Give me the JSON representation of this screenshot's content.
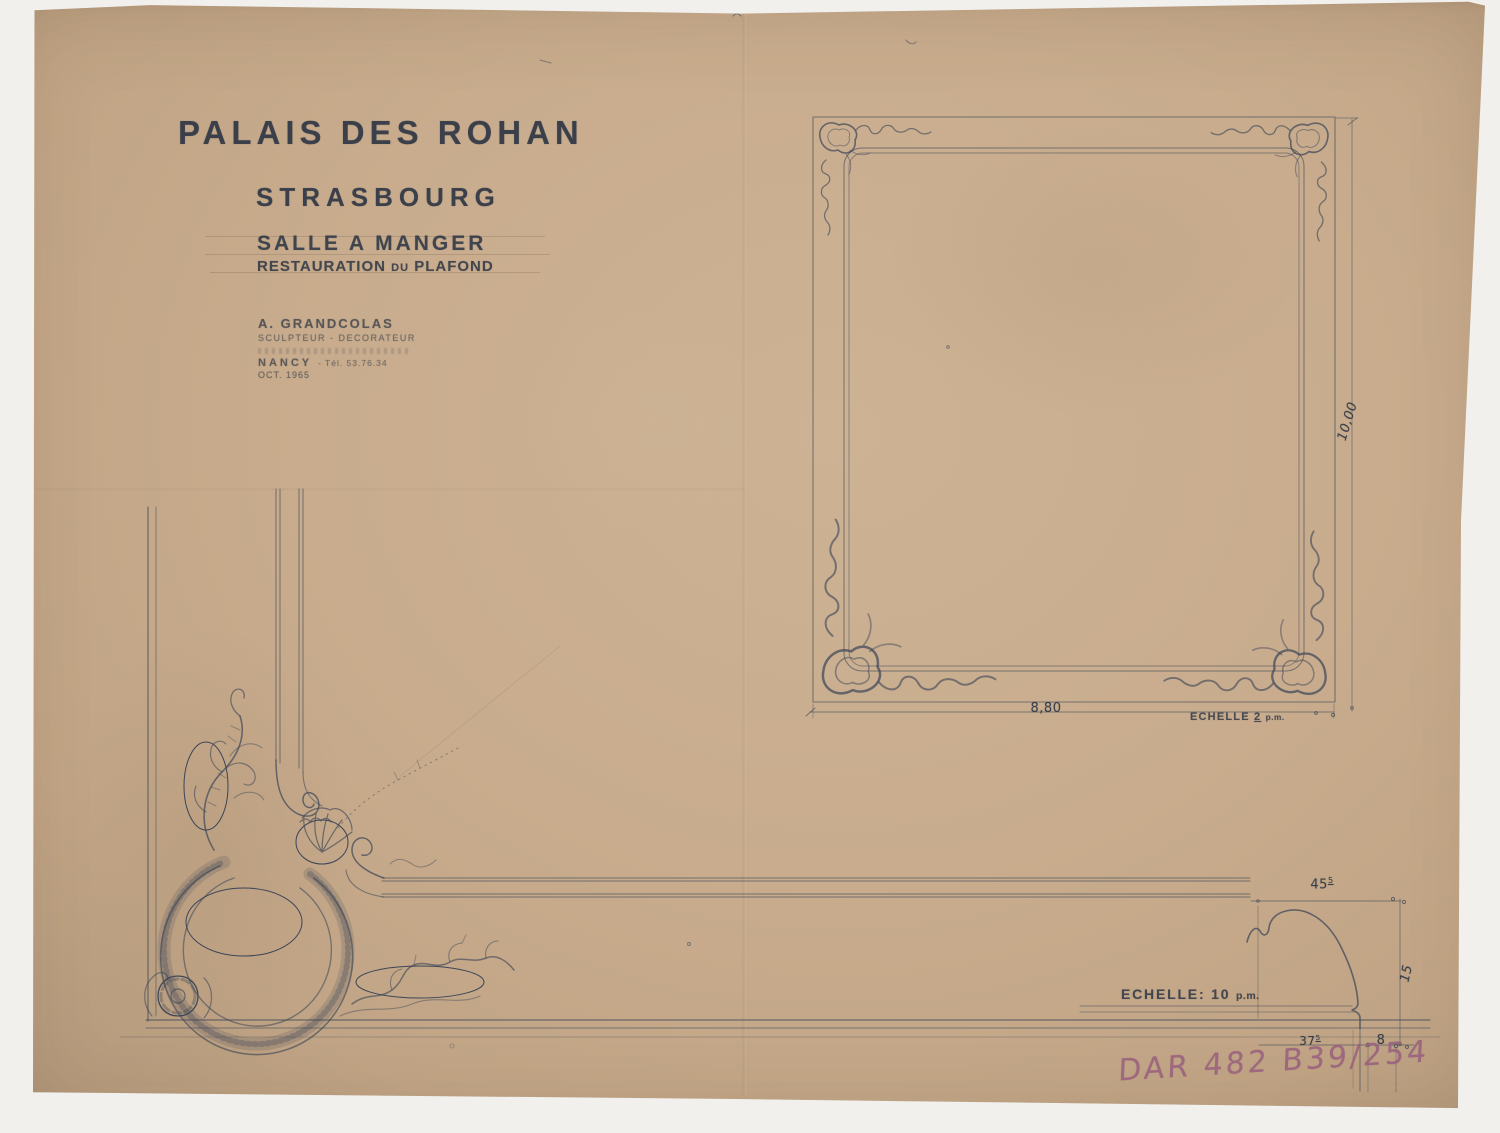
{
  "sheet": {
    "title": {
      "line1": "PALAIS DES ROHAN",
      "line2": "STRASBOURG",
      "sub1": "SALLE A MANGER",
      "sub2_word1": "RESTAURATION",
      "sub2_word2": "DU",
      "sub2_word3": "PLAFOND"
    },
    "credit": {
      "name": "A. GRANDCOLAS",
      "role": "SCULPTEUR - DECORATEUR",
      "city": "NANCY",
      "phone": "- Tél. 53.76.34",
      "date": "OCT. 1965"
    },
    "plan": {
      "width_dim": "8,80",
      "height_dim": "10,00",
      "scale_label": "ECHELLE",
      "scale_value": "2",
      "scale_unit": "p.m."
    },
    "profile": {
      "scale_label": "ECHELLE:",
      "scale_value": "10",
      "scale_unit": "p.m.",
      "dim_top_main": "45",
      "dim_top_sup": "5",
      "dim_right": "15",
      "dim_bottom_main": "37",
      "dim_bottom_sup": "5",
      "dim_step": "8"
    },
    "archive_number": "DAR 482 B39/254",
    "colors": {
      "paper": "#c8ad8e",
      "ink": "#3b4557",
      "stamp": "#9c6781",
      "background": "#f1f0ed"
    }
  }
}
